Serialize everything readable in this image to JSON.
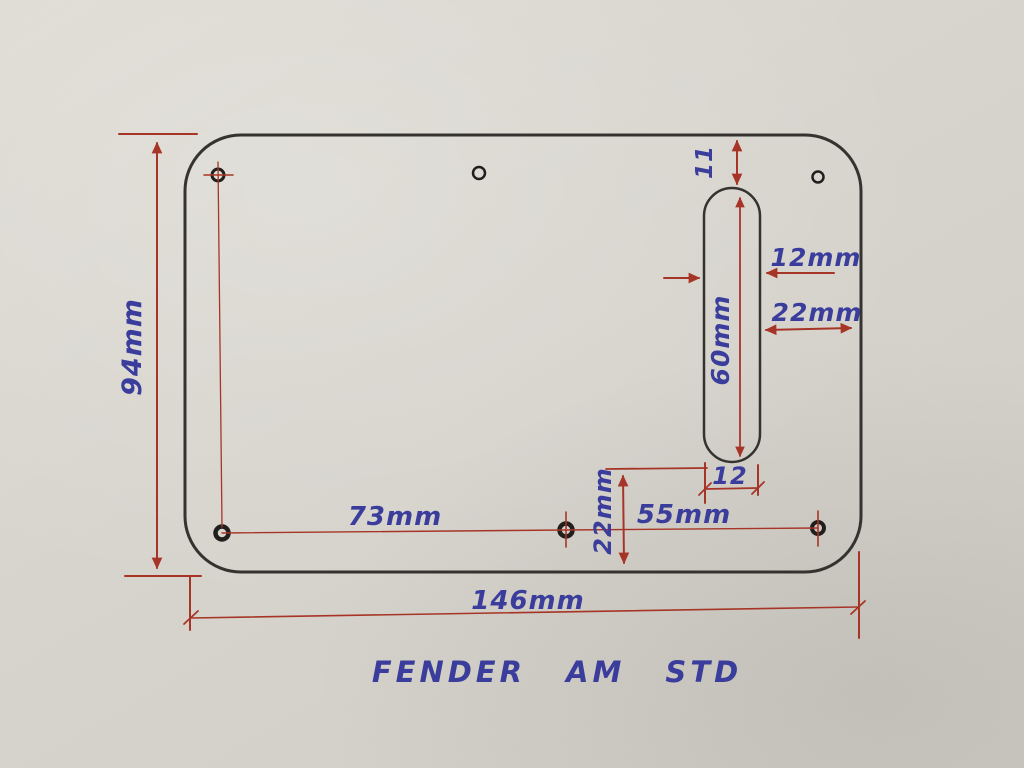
{
  "title": "FENDER AM STD",
  "labels": {
    "plate_height": "94mm",
    "plate_width": "146mm",
    "hole_span_left": "73mm",
    "hole_span_right": "55mm",
    "slot_top_gap": "11",
    "slot_width": "12mm",
    "slot_to_right_edge": "22mm",
    "slot_length": "60mm",
    "slot_end_width": "12",
    "slot_bottom_gap": "22mm"
  },
  "colors": {
    "paper": "#d7d4cd",
    "ink_outline": "#35332f",
    "ink_dimension": "#a73527",
    "ink_text": "#3a3d9b"
  }
}
